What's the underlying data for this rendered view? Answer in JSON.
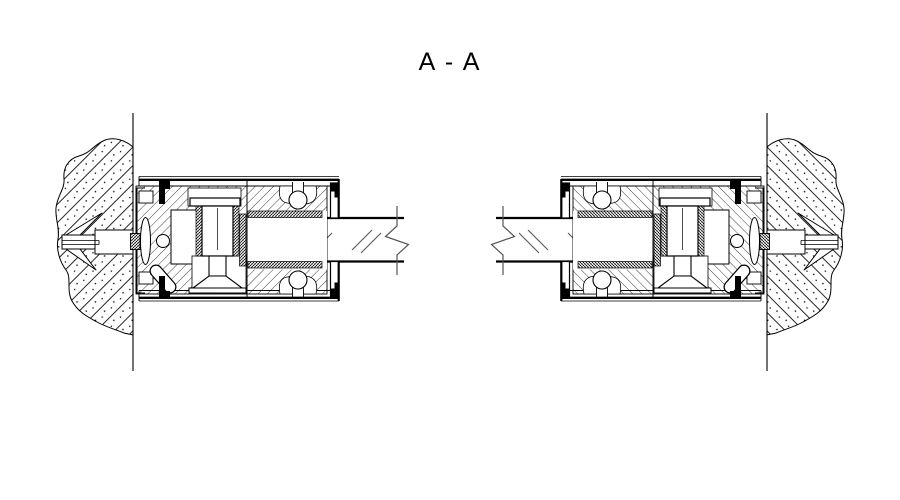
{
  "title": "A - A",
  "colors": {
    "ink": "#000000",
    "paper": "#ffffff"
  },
  "drawing": {
    "kind": "engineering-section-drawing",
    "assemblies": [
      {
        "side": "left",
        "parts": [
          "concrete wall (hatched)",
          "expansion anchor with wings",
          "glass clamp fitting (hatched steel, bolt, gaskets)",
          "glass panel with break line"
        ]
      },
      {
        "side": "right",
        "parts": [
          "glass panel with break line",
          "glass clamp fitting (hatched steel, bolt, gaskets)",
          "expansion anchor with wings",
          "concrete wall (hatched)"
        ]
      }
    ]
  }
}
